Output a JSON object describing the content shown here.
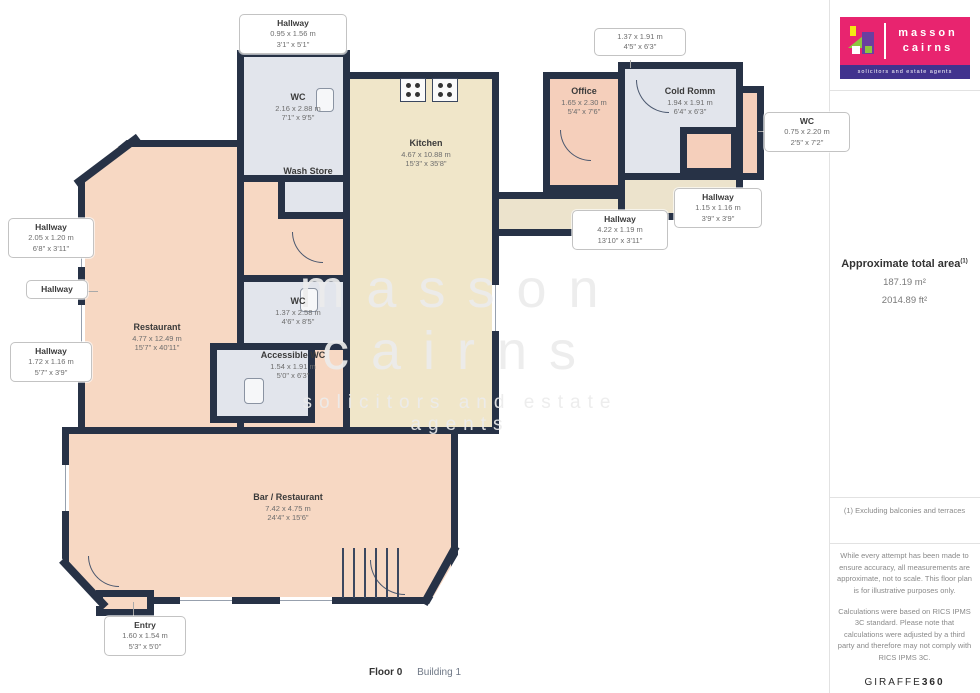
{
  "colors": {
    "wall": "#273246",
    "restaurant_fill": "#f7d8c3",
    "kitchen_fill": "#f0e6c9",
    "wc_fill": "#e2e5ec",
    "office_fill": "#f5cfbb",
    "hallway_fill": "#ece3cc",
    "logo_pink": "#e8246f",
    "logo_purple": "#41338e",
    "logo_green": "#8dc63f",
    "logo_yellow": "#f4e813",
    "logo_house_purple": "#6a3fa0"
  },
  "plan": {
    "watermark": {
      "line1": "masson",
      "line2": "cairns",
      "tagline": "solicitors and estate agents"
    },
    "footer": {
      "floor": "Floor 0",
      "building": "Building 1"
    },
    "labels": {
      "hallway_top": {
        "name": "Hallway",
        "m": "0.95 x 1.56 m",
        "ft": "3'1\" x 5'1\""
      },
      "wc_top": {
        "name": "WC",
        "m": "2.16 x 2.88 m",
        "ft": "7'1\" x 9'5\""
      },
      "wash_store": {
        "name": "Wash Store"
      },
      "kitchen": {
        "name": "Kitchen",
        "m": "4.67 x 10.88 m",
        "ft": "15'3\" x 35'8\""
      },
      "office": {
        "name": "Office",
        "m": "1.65 x 2.30 m",
        "ft": "5'4\" x 7'6\""
      },
      "cold_room": {
        "name": "Cold Romm",
        "m": "1.94 x 1.91 m",
        "ft": "6'4\" x 6'3\""
      },
      "unnamed_top": {
        "m": "1.37 x 1.91 m",
        "ft": "4'5\" x 6'3\""
      },
      "wc_right": {
        "name": "WC",
        "m": "0.75 x 2.20 m",
        "ft": "2'5\" x 7'2\""
      },
      "hallway_right": {
        "name": "Hallway",
        "m": "1.15 x 1.16 m",
        "ft": "3'9\" x 3'9\""
      },
      "hallway_mid": {
        "name": "Hallway",
        "m": "4.22 x 1.19 m",
        "ft": "13'10\" x 3'11\""
      },
      "hallway_left1": {
        "name": "Hallway",
        "m": "2.05 x 1.20 m",
        "ft": "6'8\" x 3'11\""
      },
      "hallway_plain": {
        "name": "Hallway"
      },
      "hallway_left2": {
        "name": "Hallway",
        "m": "1.72 x 1.16 m",
        "ft": "5'7\" x 3'9\""
      },
      "restaurant": {
        "name": "Restaurant",
        "m": "4.77 x 12.49 m",
        "ft": "15'7\" x 40'11\""
      },
      "wc_mid": {
        "name": "WC",
        "m": "1.37 x 2.58 m",
        "ft": "4'6\" x 8'5\""
      },
      "accessible_wc": {
        "name": "Accessible WC",
        "m": "1.54 x 1.91 m",
        "ft": "5'0\" x 6'3\""
      },
      "bar": {
        "name": "Bar / Restaurant",
        "m": "7.42 x 4.75 m",
        "ft": "24'4\" x 15'6\""
      },
      "entry": {
        "name": "Entry",
        "m": "1.60 x 1.54 m",
        "ft": "5'3\" x 5'0\""
      }
    }
  },
  "sidebar": {
    "logo": {
      "line1": "masson",
      "line2": "cairns",
      "tagline": "solicitors and estate agents"
    },
    "area": {
      "title": "Approximate total area",
      "superscript": "(1)",
      "m2": "187.19 m²",
      "ft2": "2014.89 ft²"
    },
    "note": "(1) Excluding balconies and terraces",
    "disclaimer1": "While every attempt has been made to ensure accuracy, all measurements are approximate, not to scale. This floor plan is for illustrative purposes only.",
    "disclaimer2": "Calculations were based on RICS IPMS 3C standard. Please note that calculations were adjusted by a third party and therefore may not comply with RICS IPMS 3C.",
    "brand": {
      "name": "GIRAFFE",
      "suffix": "360"
    }
  }
}
